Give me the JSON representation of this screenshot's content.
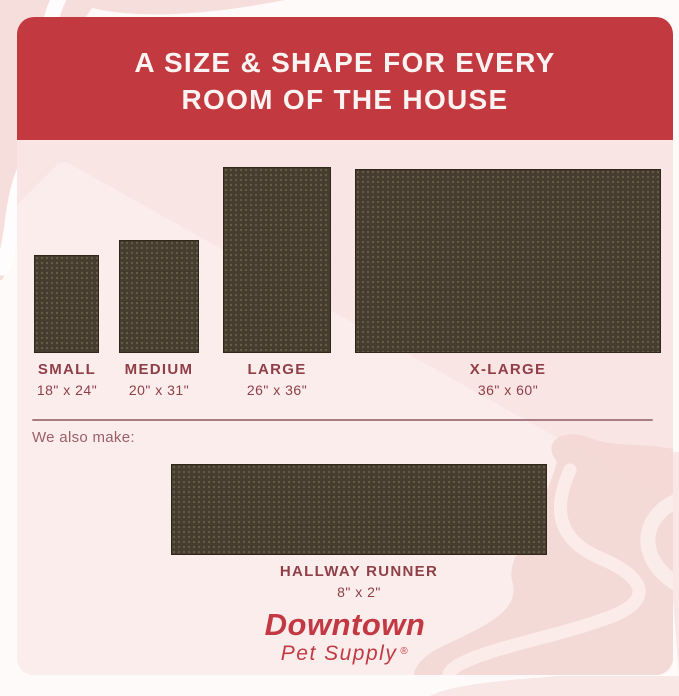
{
  "header": {
    "line1": "A SIZE & SHAPE FOR EVERY",
    "line2": "ROOM OF THE HOUSE"
  },
  "sizes": [
    {
      "name": "SMALL",
      "dims": "18\" x 24\""
    },
    {
      "name": "MEDIUM",
      "dims": "20\" x 31\""
    },
    {
      "name": "LARGE",
      "dims": "26\" x 36\""
    },
    {
      "name": "X-LARGE",
      "dims": "36\" x 60\""
    }
  ],
  "also": {
    "label": "We also make:",
    "runner": {
      "name": "HALLWAY RUNNER",
      "dims": "8\" x 2\""
    }
  },
  "brand": {
    "name": "Downtown",
    "subtitle": "Pet Supply",
    "registered": "®"
  },
  "colors": {
    "header_bg": "#C23A40",
    "header_text": "#FBF3F1",
    "card_bg": "#F9E5E3",
    "card_highlight": "#FBEDEB",
    "mat_brown": "#463C2F",
    "label_red": "#8E3F48",
    "divider": "#A87C80",
    "brand_red": "#C23944",
    "decoration_pink": "#F3D7D5"
  }
}
